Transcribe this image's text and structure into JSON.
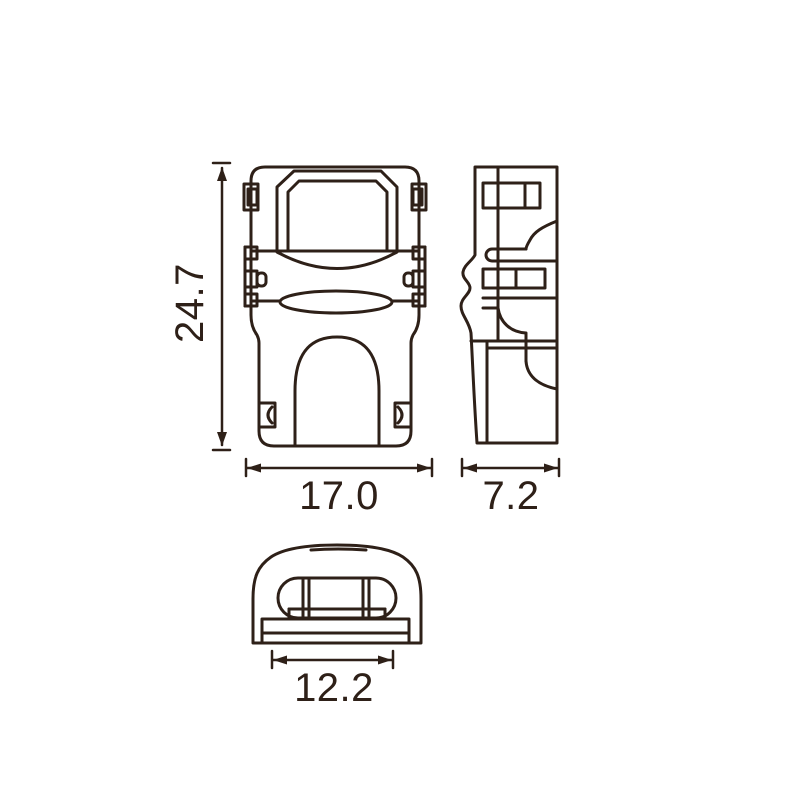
{
  "colors": {
    "line": "#2e2018",
    "background": "#ffffff"
  },
  "dimensions": {
    "height_label": "24.7",
    "width_label": "17.0",
    "depth_label": "7.2",
    "base_width_label": "12.2"
  }
}
